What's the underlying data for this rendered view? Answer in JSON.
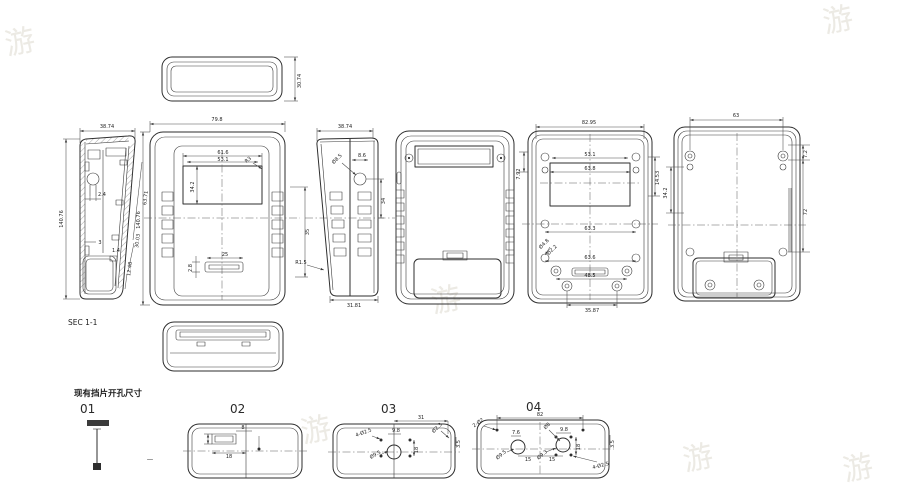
{
  "watermark": {
    "glyph": "游"
  },
  "views": {
    "top": {
      "h": "30.74"
    },
    "sec": {
      "label": "SEC 1-1",
      "w": "38.74",
      "h": "140.76",
      "boss": "2.4",
      "rib": "3",
      "slant1": "63.71",
      "slant2": "30.03",
      "slant3": "12.48",
      "peg": "1.4"
    },
    "front": {
      "w": "79.8",
      "h": "140.76",
      "win_outer": "61.6",
      "win_inner": "53.1",
      "win_h": "34.2",
      "corner_r": "R3",
      "right": "35",
      "slot_h": "2.8",
      "slot_w": "25"
    },
    "side": {
      "w": "38.74",
      "hole": "Ø8.5",
      "hole_off": "8.6",
      "hole_v": "34",
      "bottom": "31.81",
      "flare_r": "R1.5"
    },
    "back_inner": {
      "w": "82.95",
      "win1": "53.1",
      "win2": "63.8",
      "left": "7.92",
      "right": "14.53",
      "mid": "63.3",
      "post1": "Ø4.8",
      "post2": "Ø2.2",
      "low1": "63.6",
      "low2": "48.5",
      "low3": "35.87"
    },
    "front_inner": {
      "w": "63",
      "left": "34.2",
      "right_top": "7.2",
      "right": "72"
    }
  },
  "details": {
    "note": "现有挡片开孔尺寸",
    "d01": {
      "label": "01",
      "dash": "—"
    },
    "d02": {
      "label": "02",
      "slot_h": "8",
      "slot_w": "18"
    },
    "d03": {
      "label": "03",
      "w": "31",
      "holes": "4-Ø2.5",
      "pitch": "9.8",
      "hole_d": "Ø9.5",
      "corner": "Ø2.3",
      "v": "18",
      "edge": "3.5"
    },
    "d04": {
      "label": "04",
      "w": "82",
      "top_holes": "2-Ø2",
      "a": "7.6",
      "hole_l": "Ø9.5",
      "hole_r": "Ø9.3",
      "top_d": "Ø8",
      "pitch": "9.8",
      "v": "18",
      "s1": "15",
      "s2": "15",
      "holes": "4-Ø2.5",
      "edge": "3.5"
    }
  }
}
